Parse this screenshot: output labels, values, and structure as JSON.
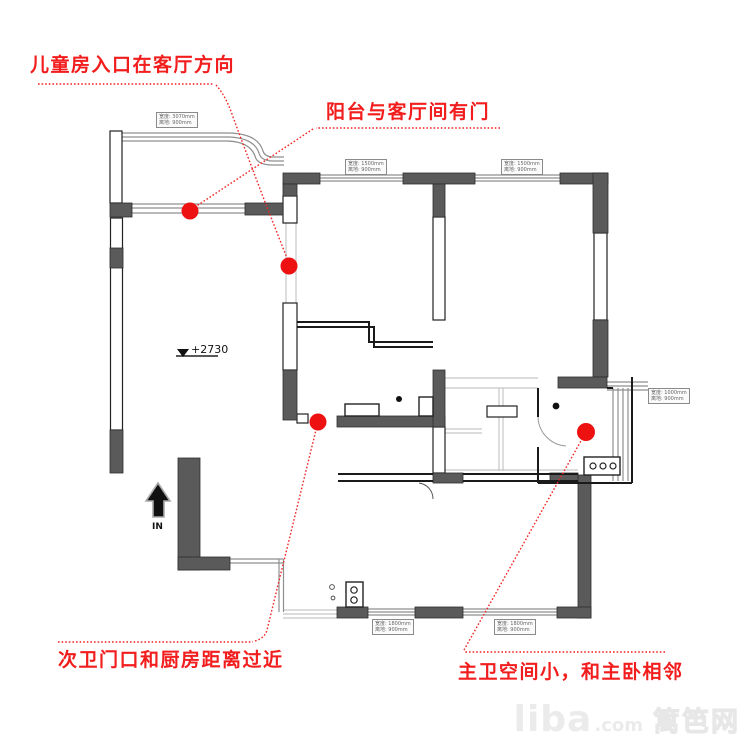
{
  "annotations": {
    "children_room_entry": "儿童房入口在客厅方向",
    "balcony_living_door": "阳台与客厅间有门",
    "second_bath_kitchen": "次卫门口和厨房距离过近",
    "master_bath_small": "主卫空间小，和主卧相邻"
  },
  "plan": {
    "level_marker": "+2730",
    "entry_label": "IN",
    "dim_labels": [
      {
        "l1": "宽度: 3070mm",
        "l2": "离地: 900mm"
      },
      {
        "l1": "宽度: 1500mm",
        "l2": "离地: 900mm"
      },
      {
        "l1": "宽度: 1500mm",
        "l2": "离地: 900mm"
      },
      {
        "l1": "宽度: 1000mm",
        "l2": "离地: 900mm"
      },
      {
        "l1": "宽度: 1800mm",
        "l2": "离地: 900mm"
      },
      {
        "l1": "宽度: 1800mm",
        "l2": "离地: 900mm"
      }
    ]
  },
  "colors": {
    "accent": "#ee1c1c",
    "wall_dark": "#5a5a5a",
    "watermark": "#ebebeb"
  },
  "watermark": {
    "brand": "liba",
    "suffix": ".com",
    "site_name": "篱笆网"
  }
}
